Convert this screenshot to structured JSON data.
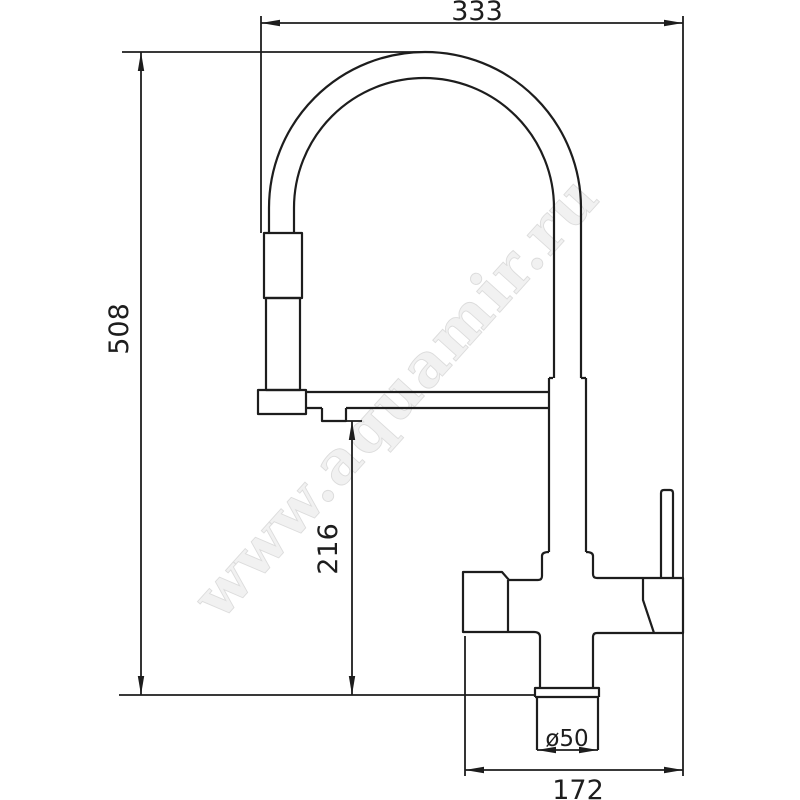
{
  "page": {
    "background": "#ffffff"
  },
  "drawing": {
    "line_color": "#1d1d1d",
    "watermark": {
      "text": "www.aquamir.ru",
      "color": "#f1f1f1",
      "outline_color": "#dcdcdc"
    },
    "dimensions": {
      "overall_width": "333",
      "overall_height": "508",
      "spout_outlet_height": "216",
      "base_span": "172",
      "base_diameter": "ø50"
    }
  }
}
